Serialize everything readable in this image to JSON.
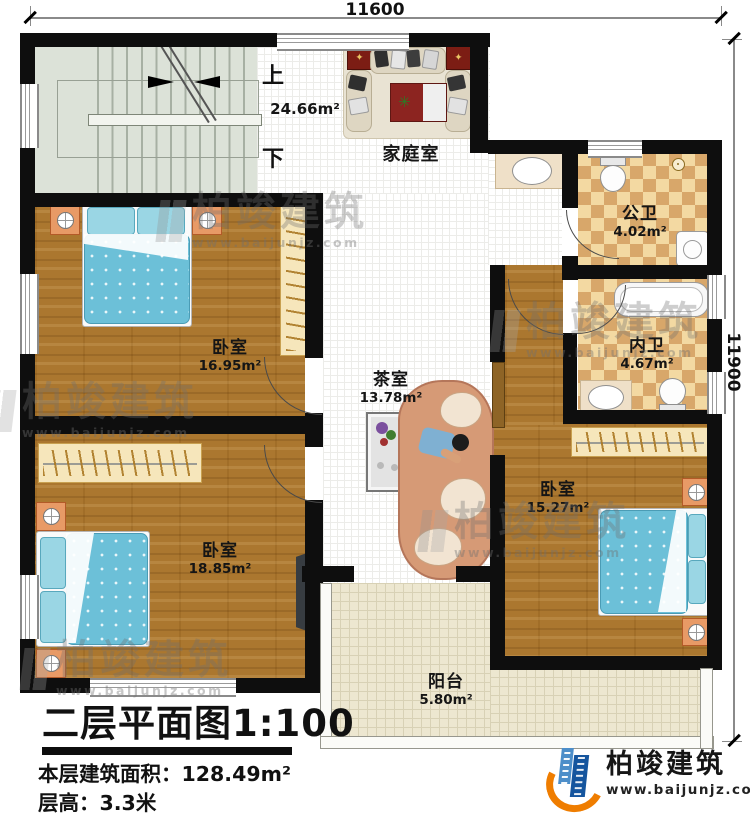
{
  "plan": {
    "dimensions": {
      "width_mm": "11600",
      "height_mm": "11900"
    },
    "stairs": {
      "up_label": "上",
      "down_label": "下"
    },
    "rooms": {
      "family_room": {
        "name": "家庭室",
        "area": "24.66m²"
      },
      "public_bathroom": {
        "name": "公卫",
        "area": "4.02m²"
      },
      "inner_bathroom": {
        "name": "内卫",
        "area": "4.67m²"
      },
      "bedroom_top_left": {
        "name": "卧室",
        "area": "16.95m²"
      },
      "tea_room": {
        "name": "茶室",
        "area": "13.78m²"
      },
      "bedroom_right": {
        "name": "卧室",
        "area": "15.27m²"
      },
      "bedroom_bottom_left": {
        "name": "卧室",
        "area": "18.85m²"
      },
      "balcony": {
        "name": "阳台",
        "area": "5.80m²"
      }
    }
  },
  "title_block": {
    "title": "二层平面图1:100",
    "floor_area_label": "本层建筑面积：",
    "floor_area_value": "128.49m²",
    "floor_height_label": "层高：",
    "floor_height_value": "3.3米"
  },
  "branding": {
    "company": "柏竣建筑",
    "website": "www.baijunjz.com"
  },
  "watermark": {
    "company": "柏竣建筑",
    "website": "www.baijunjz.com"
  },
  "colors": {
    "wall": "#0e0e0e",
    "wood_floor": "#ab772f",
    "bath_tile_light": "#f3d9a2",
    "bath_tile_dark": "#d8a76a",
    "bed_blue": "#6cc0d8",
    "stair_floor": "#dce2d8",
    "balcony_floor": "#ede7d0",
    "brand_blue": "#15559e",
    "brand_orange": "#ef7d00"
  }
}
